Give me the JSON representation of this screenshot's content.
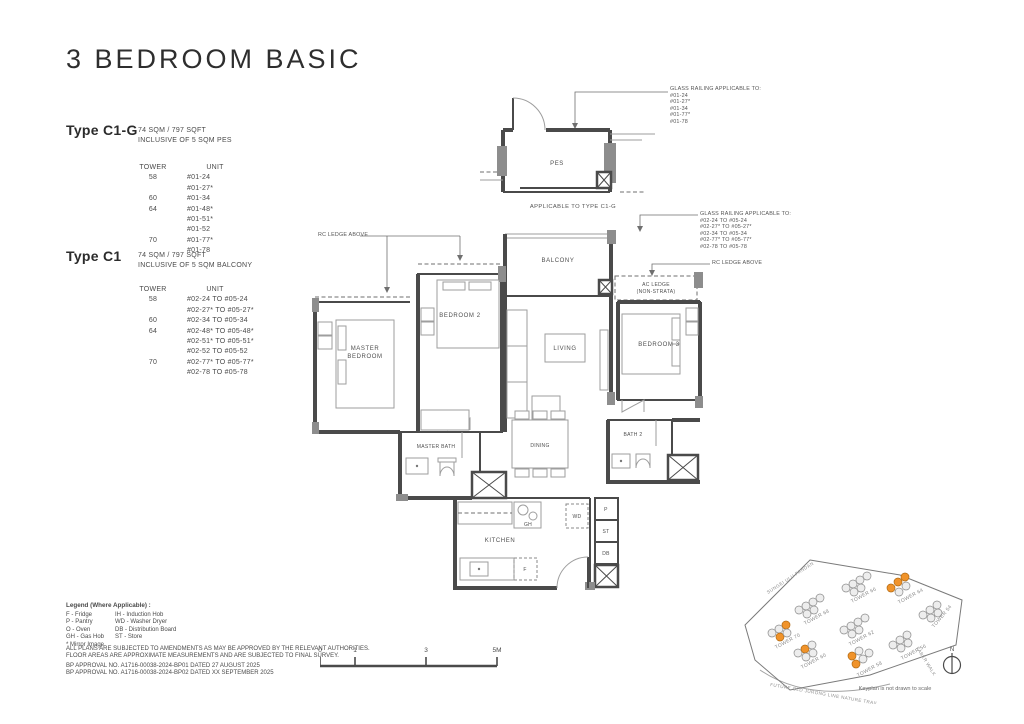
{
  "page": {
    "title": "3 BEDROOM BASIC"
  },
  "colors": {
    "accent": "#f0932a",
    "wall": "#4a4a4a"
  },
  "type_c1g": {
    "name": "Type C1-G",
    "area": "74 SQM / 797 SQFT",
    "inclusive": "INCLUSIVE OF 5 SQM PES",
    "tower_header": "TOWER",
    "unit_header": "UNIT",
    "rows": [
      {
        "tower": "58",
        "unit": "#01-24"
      },
      {
        "tower": "",
        "unit": "#01-27*"
      },
      {
        "tower": "60",
        "unit": "#01-34"
      },
      {
        "tower": "64",
        "unit": "#01-48*"
      },
      {
        "tower": "",
        "unit": "#01-51*"
      },
      {
        "tower": "",
        "unit": "#01-52"
      },
      {
        "tower": "70",
        "unit": "#01-77*"
      },
      {
        "tower": "",
        "unit": "#01-78"
      }
    ]
  },
  "type_c1": {
    "name": "Type C1",
    "area": "74 SQM / 797 SQFT",
    "inclusive": "INCLUSIVE OF 5 SQM BALCONY",
    "tower_header": "TOWER",
    "unit_header": "UNIT",
    "rows": [
      {
        "tower": "58",
        "unit": "#02-24 TO #05-24"
      },
      {
        "tower": "",
        "unit": "#02-27* TO #05-27*"
      },
      {
        "tower": "60",
        "unit": "#02-34 TO #05-34"
      },
      {
        "tower": "64",
        "unit": "#02-48* TO #05-48*"
      },
      {
        "tower": "",
        "unit": "#02-51* TO #05-51*"
      },
      {
        "tower": "",
        "unit": "#02-52 TO #05-52"
      },
      {
        "tower": "70",
        "unit": "#02-77* TO #05-77*"
      },
      {
        "tower": "",
        "unit": "#02-78 TO #05-78"
      }
    ]
  },
  "mini_plan": {
    "room": "PES",
    "caption": "APPLICABLE TO TYPE C1-G",
    "annotation_title": "GLASS RAILING APPLICABLE TO:",
    "annotation_units": [
      "#01-24",
      "#01-27*",
      "#01-34",
      "#01-77*",
      "#01-78"
    ]
  },
  "main_plan": {
    "labels": {
      "master_bedroom_1": "MASTER",
      "master_bedroom_2": "BEDROOM",
      "bedroom2": "BEDROOM 2",
      "bedroom3": "BEDROOM 3",
      "balcony": "BALCONY",
      "living": "LIVING",
      "ac_ledge_1": "AC LEDGE",
      "ac_ledge_2": "(NON-STRATA)",
      "master_bath": "MASTER BATH",
      "dining": "DINING",
      "bath2": "BATH 2",
      "kitchen": "KITCHEN",
      "pantry": "P",
      "store": "ST",
      "db": "DB",
      "wd": "WD",
      "fridge": "F",
      "gas_hob": "GH"
    },
    "annotations": {
      "rc_ledge_left": "RC LEDGE ABOVE",
      "rc_ledge_right": "RC LEDGE ABOVE",
      "glass_railing_title": "GLASS RAILING APPLICABLE TO:",
      "glass_railing_units": [
        "#02-24 TO #05-24",
        "#02-27* TO #05-27*",
        "#02-34 TO #05-34",
        "#02-77* TO #05-77*",
        "#02-78 TO #05-78"
      ]
    }
  },
  "legend": {
    "title": "Legend (Where Applicable) :",
    "col1": [
      "F - Fridge",
      "P - Pantry",
      "O - Oven",
      "GH - Gas Hob",
      "* Mirror Image"
    ],
    "col2": [
      "IH - Induction Hob",
      "WD - Washer Dryer",
      "DB - Distribution Board",
      "ST - Store"
    ],
    "disclaimer": [
      "ALL PLANS ARE SUBJECTED TO AMENDMENTS AS MAY BE APPROVED BY THE RELEVANT AUTHORITIES.",
      "FLOOR AREAS ARE APPROXIMATE MEASUREMENTS AND ARE SUBJECTED TO FINAL SURVEY."
    ],
    "approvals": [
      "BP APPROVAL NO. A1716-00038-2024-BP01  DATED 27 AUGUST 2025",
      "BP APPROVAL NO. A1716-00038-2024-BP02  DATED XX SEPTEMBER 2025"
    ]
  },
  "scale_bar": {
    "labels": [
      "0",
      "1",
      "3",
      "5M"
    ]
  },
  "keyplan": {
    "towers": [
      {
        "name": "TOWER 70",
        "highlight": true
      },
      {
        "name": "TOWER 68",
        "highlight": false
      },
      {
        "name": "TOWER 66",
        "highlight": false
      },
      {
        "name": "TOWER 64",
        "highlight": true
      },
      {
        "name": "TOWER 62",
        "highlight": false
      },
      {
        "name": "TOWER 60",
        "highlight": true
      },
      {
        "name": "TOWER 58",
        "highlight": true
      },
      {
        "name": "TOWER 56",
        "highlight": false
      },
      {
        "name": "TOWER 54",
        "highlight": false
      }
    ],
    "roads": [
      "SUNGEI ULU PANDAN",
      "FUTURE OLD JURONG LINE NATURE TRAIL",
      "FABER WALK"
    ],
    "note": "Keyplan is not drawn to scale",
    "north_label": "N"
  }
}
